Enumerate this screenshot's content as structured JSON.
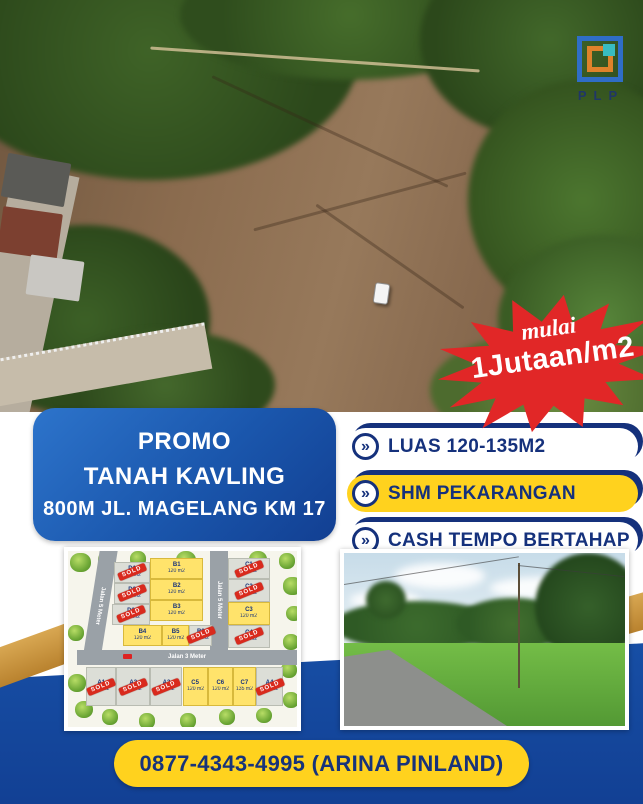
{
  "logo": {
    "text": "PLP"
  },
  "price_badge": {
    "prefix": "mulai",
    "value": "1Jutaan/m2"
  },
  "promo": {
    "line1": "PROMO",
    "line2": "TANAH KAVLING",
    "line3": "800M JL. MAGELANG KM 17"
  },
  "features": [
    {
      "label": "LUAS 120-135M2",
      "variant": "white"
    },
    {
      "label": "SHM PEKARANGAN",
      "variant": "yellow"
    },
    {
      "label": "CASH TEMPO BERTAHAP",
      "variant": "white"
    }
  ],
  "contact": {
    "label": "0877-4343-4995 (ARINA PINLAND)"
  },
  "siteplan": {
    "sold_stamp": "SOLD",
    "roads": [
      {
        "label": "Jalan 5 Meter",
        "orientation": "vertical-left"
      },
      {
        "label": "Jalan 5 Meter",
        "orientation": "vertical-right"
      },
      {
        "label": "Jalan 3 Meter",
        "orientation": "horizontal"
      }
    ],
    "plots": [
      {
        "code": "B1",
        "area": "120 m2",
        "status": "available",
        "x": 36,
        "y": 4,
        "w": 23,
        "h": 12
      },
      {
        "code": "B2",
        "area": "120 m2",
        "status": "available",
        "x": 36,
        "y": 16,
        "w": 23,
        "h": 12
      },
      {
        "code": "B3",
        "area": "120 m2",
        "status": "available",
        "x": 36,
        "y": 28,
        "w": 23,
        "h": 12
      },
      {
        "code": "B4",
        "area": "120 m2",
        "status": "available",
        "x": 24,
        "y": 42,
        "w": 17,
        "h": 12
      },
      {
        "code": "B5",
        "area": "120 m2",
        "status": "available",
        "x": 41,
        "y": 42,
        "w": 12,
        "h": 12
      },
      {
        "code": "B6",
        "area": "120 m2",
        "status": "sold",
        "x": 53,
        "y": 42,
        "w": 10,
        "h": 12
      },
      {
        "code": "D1",
        "area": "120 m2",
        "status": "sold",
        "x": 20,
        "y": 6,
        "w": 16,
        "h": 12
      },
      {
        "code": "D2",
        "area": "120 m2",
        "status": "sold",
        "x": 20,
        "y": 18,
        "w": 16,
        "h": 12
      },
      {
        "code": "D3",
        "area": "120 m2",
        "status": "sold",
        "x": 19,
        "y": 30,
        "w": 17,
        "h": 12
      },
      {
        "code": "C1",
        "area": "120 m2",
        "status": "sold",
        "x": 70,
        "y": 4,
        "w": 18,
        "h": 12
      },
      {
        "code": "C2",
        "area": "120 m2",
        "status": "sold",
        "x": 70,
        "y": 16,
        "w": 18,
        "h": 13
      },
      {
        "code": "C3",
        "area": "120 m2",
        "status": "available",
        "x": 70,
        "y": 29,
        "w": 18,
        "h": 13
      },
      {
        "code": "C4",
        "area": "120 m2",
        "status": "sold",
        "x": 70,
        "y": 42,
        "w": 18,
        "h": 13
      },
      {
        "code": "A1",
        "area": "120 m2",
        "status": "sold",
        "x": 8,
        "y": 66,
        "w": 13,
        "h": 22
      },
      {
        "code": "A2",
        "area": "120 m2",
        "status": "sold",
        "x": 21,
        "y": 66,
        "w": 15,
        "h": 22
      },
      {
        "code": "A3",
        "area": "120 m2",
        "status": "sold",
        "x": 36,
        "y": 66,
        "w": 14,
        "h": 22
      },
      {
        "code": "C5",
        "area": "120 m2",
        "status": "available",
        "x": 50,
        "y": 66,
        "w": 11,
        "h": 22
      },
      {
        "code": "C6",
        "area": "120 m2",
        "status": "available",
        "x": 61,
        "y": 66,
        "w": 11,
        "h": 22
      },
      {
        "code": "C7",
        "area": "135 m2",
        "status": "available",
        "x": 72,
        "y": 66,
        "w": 10,
        "h": 22
      },
      {
        "code": "A4",
        "area": "120 m2",
        "status": "sold",
        "x": 82,
        "y": 66,
        "w": 12,
        "h": 22
      }
    ]
  },
  "colors": {
    "blue": "#1e63bd",
    "navy": "#15317c",
    "yellow": "#ffd21e",
    "badge_red": "#e12727",
    "gold": "#c9953f"
  }
}
